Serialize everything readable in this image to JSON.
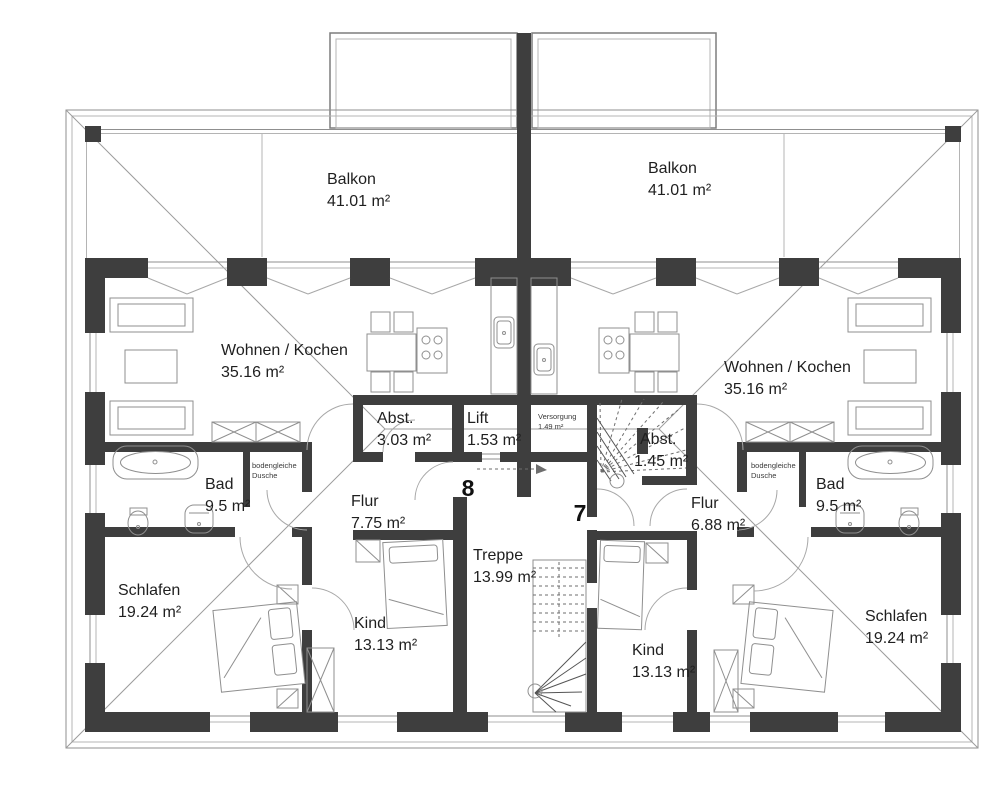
{
  "units": {
    "left_number": "8",
    "right_number": "7"
  },
  "rooms": {
    "balkon_left": {
      "name": "Balkon",
      "area": "41.01 m²"
    },
    "balkon_right": {
      "name": "Balkon",
      "area": "41.01 m²"
    },
    "wohnen_left": {
      "name": "Wohnen / Kochen",
      "area": "35.16 m²"
    },
    "wohnen_right": {
      "name": "Wohnen / Kochen",
      "area": "35.16 m²"
    },
    "abst_left": {
      "name": "Abst.",
      "area": "3.03 m²"
    },
    "lift": {
      "name": "Lift",
      "area": "1.53 m²"
    },
    "versorgung": {
      "name": "Versorgung",
      "area": "1.49 m²"
    },
    "abst_right": {
      "name": "Abst.",
      "area": "1.45 m²"
    },
    "bad_left": {
      "name": "Bad",
      "area": "9.5 m²"
    },
    "bad_right": {
      "name": "Bad",
      "area": "9.5 m²"
    },
    "flur_left": {
      "name": "Flur",
      "area": "7.75 m²"
    },
    "flur_right": {
      "name": "Flur",
      "area": "6.88 m²"
    },
    "schlafen_left": {
      "name": "Schlafen",
      "area": "19.24 m²"
    },
    "schlafen_right": {
      "name": "Schlafen",
      "area": "19.24 m²"
    },
    "kind_left": {
      "name": "Kind",
      "area": "13.13 m²"
    },
    "kind_right": {
      "name": "Kind",
      "area": "13.13 m²"
    },
    "treppe": {
      "name": "Treppe",
      "area": "13.99 m²"
    }
  },
  "annotations": {
    "shower": {
      "line1": "bodengleiche",
      "line2": "Dusche"
    }
  },
  "colors": {
    "wall": "#3e3e3e",
    "thin_line": "#8f8f8f",
    "text": "#1f1f1f",
    "background": "#ffffff"
  }
}
